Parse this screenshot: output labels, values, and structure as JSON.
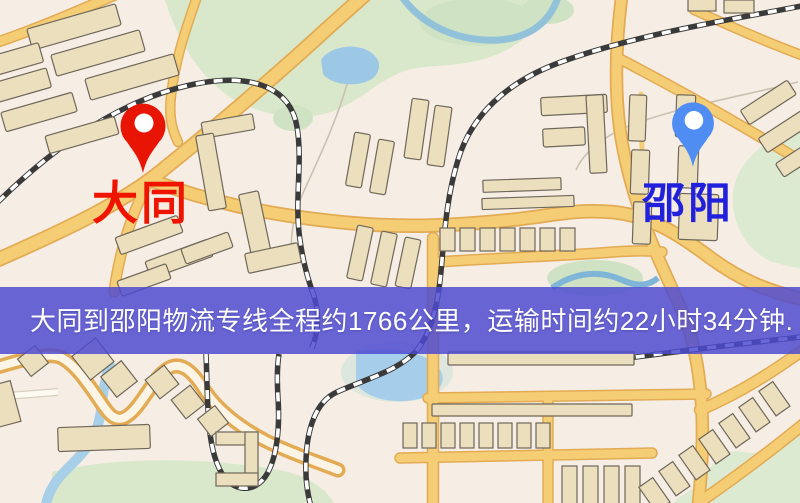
{
  "banner": {
    "text": "大同到邵阳物流专线全程约1766公里，运输时间约22小时34分钟.",
    "bg_color": "#4d4ad0",
    "text_color": "#ffffff"
  },
  "markers": {
    "origin": {
      "label": "大同",
      "pin_color": "#e81504",
      "label_color": "#ee1400"
    },
    "destination": {
      "label": "邵阳",
      "pin_color": "#4f8df2",
      "label_color": "#2121dd"
    }
  },
  "map_colors": {
    "background": "#f6efe4",
    "park_green": "#d9e8cb",
    "water_blue": "#a3cbe8",
    "road_yellow": "#f5cd74",
    "road_casing": "#e2ab54",
    "railway_dark": "#3a3a3a",
    "building_fill": "#ebdfbd",
    "building_stroke": "#6f675a"
  },
  "icons": {
    "origin_pin": "map-pin-icon",
    "destination_pin": "map-pin-icon"
  }
}
